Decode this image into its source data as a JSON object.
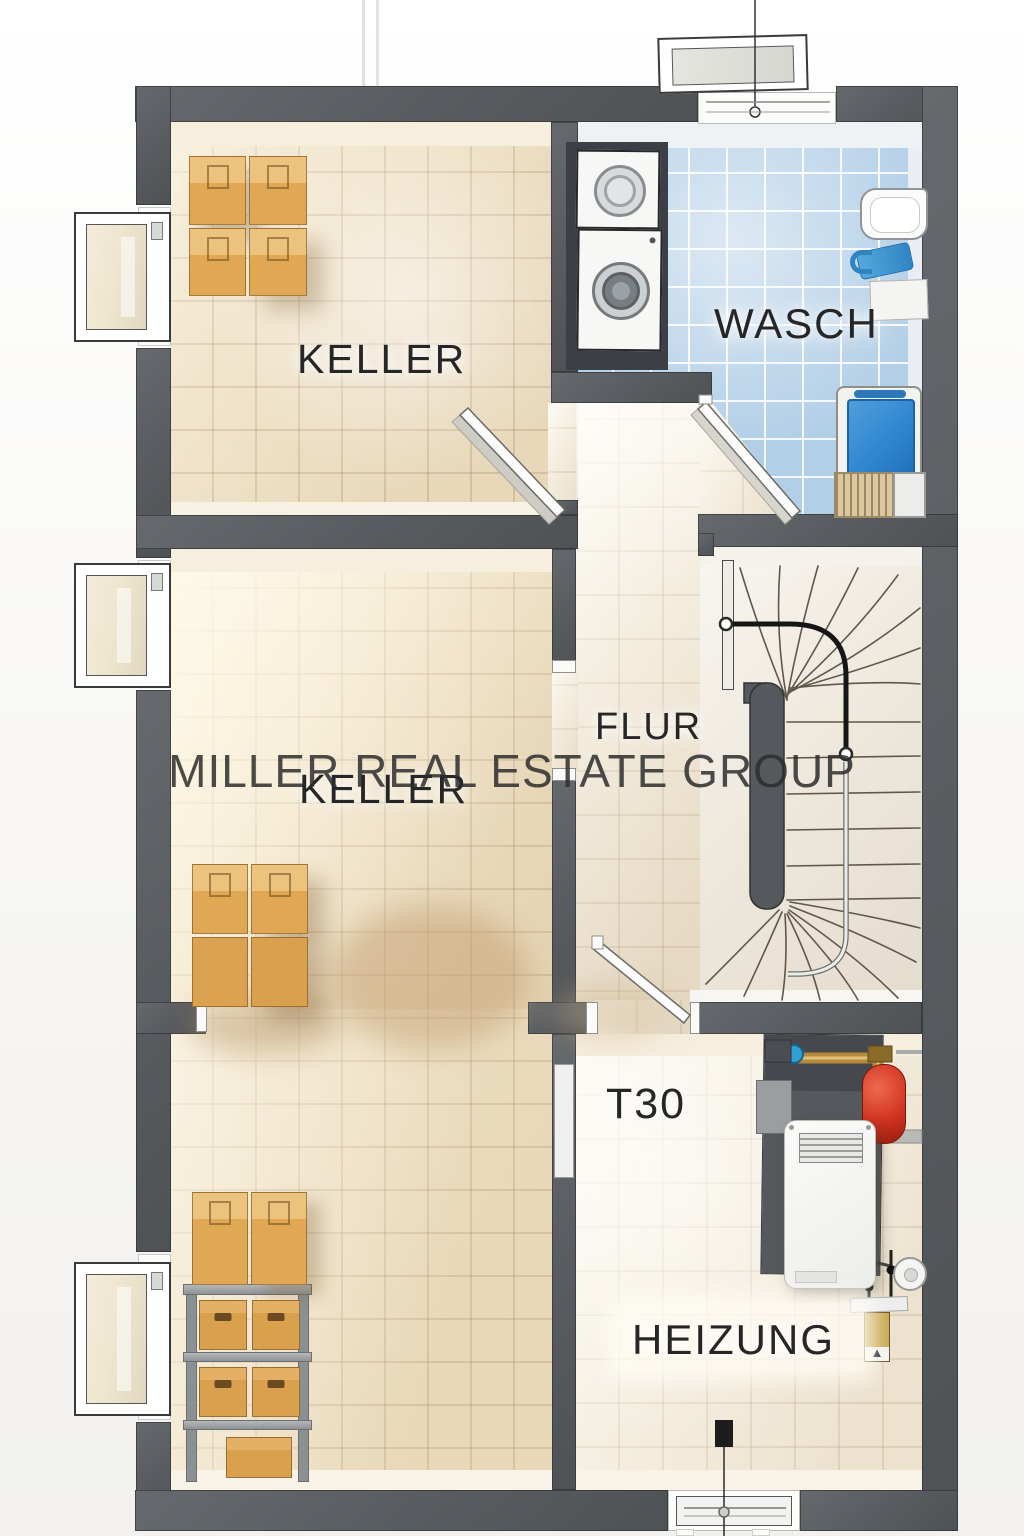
{
  "watermark": {
    "text": "MILLER REAL ESTATE GROUP"
  },
  "rooms": {
    "keller_top": {
      "label": "KELLER"
    },
    "wasch": {
      "label": "WASCH"
    },
    "flur": {
      "label": "FLUR"
    },
    "keller_main": {
      "label": "KELLER"
    },
    "heizung": {
      "label": "HEIZUNG"
    }
  },
  "annotations": {
    "fire_door": "T30"
  },
  "palette": {
    "wall_gray": "#5c5f62",
    "tile_beige": "#ecdec2",
    "tile_blue": "#b4d0e7",
    "cardboard_tan": "#dfa855",
    "expansion_tank_red": "#c03122",
    "handrail_black": "#161616",
    "label_ink": "#262626"
  }
}
